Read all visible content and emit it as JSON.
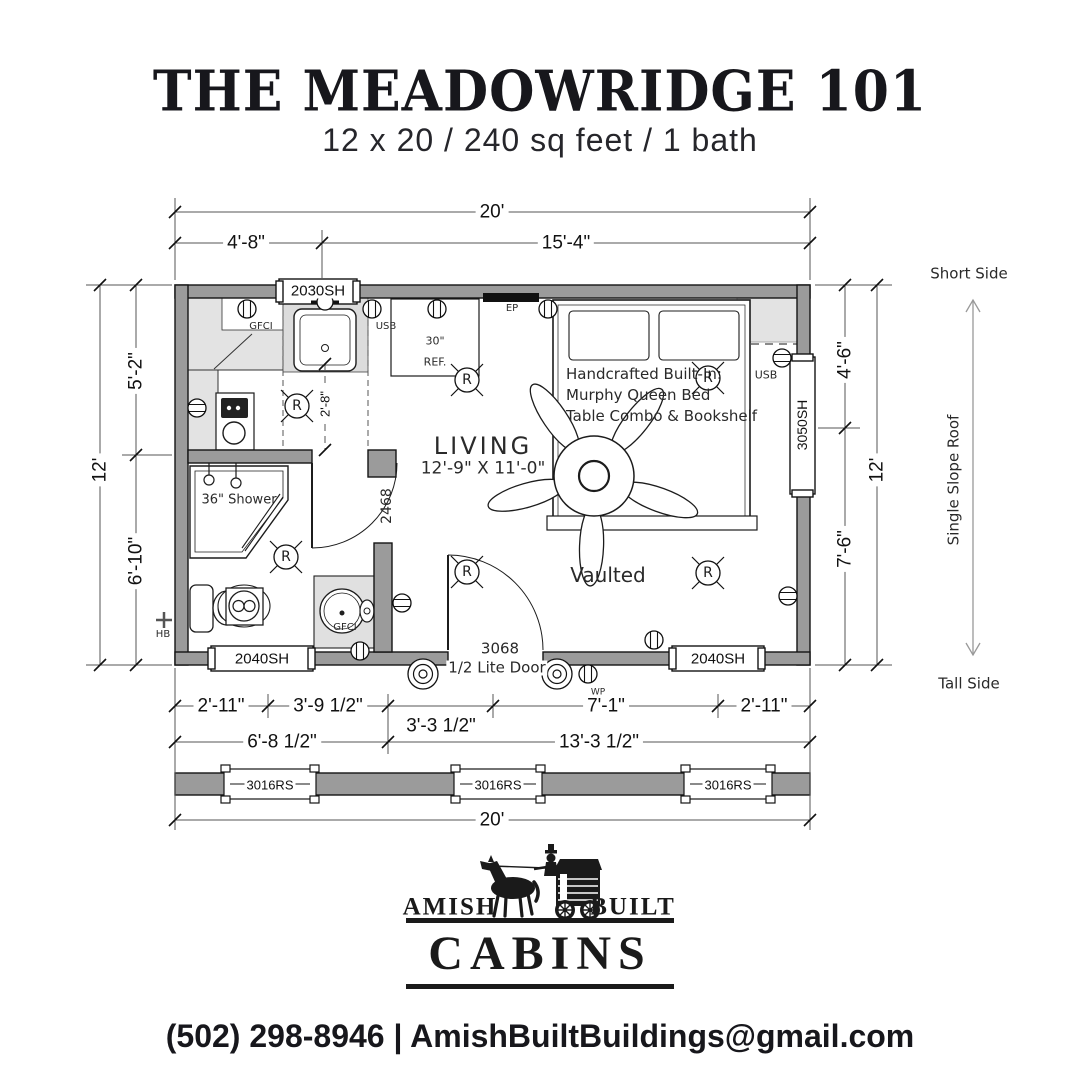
{
  "header": {
    "title": "THE MEADOWRIDGE 101",
    "subtitle": "12 x 20 / 240 sq feet / 1 bath"
  },
  "dimensions": {
    "top_overall": "20'",
    "top_left": "4'-8\"",
    "top_right": "15'-4\"",
    "left_overall": "12'",
    "left_upper": "5'-2\"",
    "left_lower": "6'-10\"",
    "right_upper": "4'-6\"",
    "right_lower": "7'-6\"",
    "right_overall": "12'",
    "bottom_1": "2'-11\"",
    "bottom_2": "3'-9 1/2\"",
    "bottom_3": "3'-3 1/2\"",
    "bottom_4": "7'-1\"",
    "bottom_5": "2'-11\"",
    "bottom_left_total": "6'-8 1/2\"",
    "bottom_right_total": "13'-3 1/2\"",
    "wall_overall": "20'",
    "counter_depth": "2'-8\""
  },
  "roof": {
    "short_side": "Short Side",
    "slope_label": "Single Slope Roof",
    "tall_side": "Tall Side"
  },
  "windows": {
    "kitchen": "2030SH",
    "bath": "2040SH",
    "living_bottom": "2040SH",
    "living_right": "3050SH",
    "transom": [
      "3016RS",
      "3016RS",
      "3016RS"
    ]
  },
  "doors": {
    "bath": "2468",
    "entry_size": "3068",
    "entry_type": "1/2 Lite Door"
  },
  "rooms": {
    "living_name": "LIVING",
    "living_size": "12'-9\" X 11'-0\"",
    "ceiling": "Vaulted",
    "shower": "36\" Shower",
    "fridge_size": "30\"",
    "fridge": "REF.",
    "bed_line1": "Handcrafted Built-In:",
    "bed_line2": "Murphy Queen Bed",
    "bed_line3": "Table Combo & Bookshelf"
  },
  "electrical": {
    "gfci_kitchen": "GFCI",
    "usb_kitchen": "USB",
    "panel": "EP",
    "usb_living": "USB",
    "gfci_bath": "GFCI",
    "weatherproof": "WP",
    "hose_bib": "HB",
    "recessed_light": "R"
  },
  "footer": {
    "brand_left": "AMISH",
    "brand_right": "BUILT",
    "brand_name": "CABINS",
    "contact": "(502) 298-8946 | AmishBuiltBuildings@gmail.com"
  },
  "colors": {
    "wall": "#9b9b9b",
    "counter": "#e3e3e3",
    "ink": "#1a1a1a"
  }
}
